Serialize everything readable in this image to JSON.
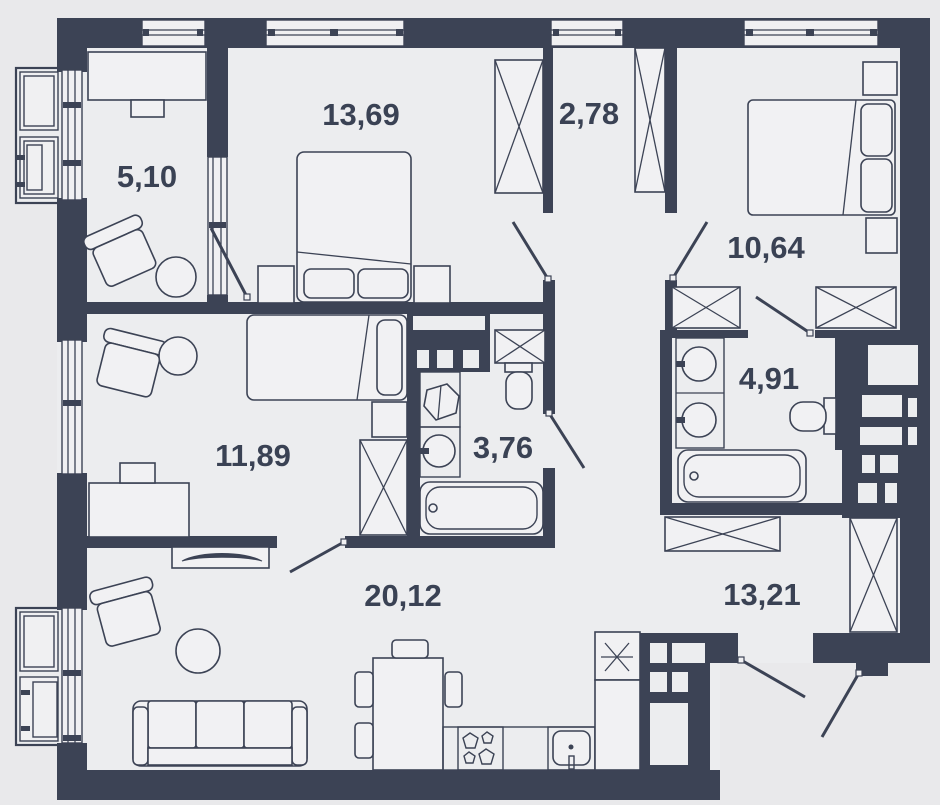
{
  "figure": {
    "type": "apartment-floor-plan",
    "description": "Top-view architectural floor plan with room areas in square meters"
  },
  "rooms": [
    {
      "id": "room-5-10",
      "area": "5,10",
      "furniture": [
        "desk",
        "office-chair",
        "stool",
        "window",
        "balcony"
      ]
    },
    {
      "id": "room-13-69",
      "area": "13,69",
      "furniture": [
        "double-bed",
        "nightstand",
        "nightstand",
        "wardrobe",
        "window"
      ]
    },
    {
      "id": "room-2-78",
      "area": "2,78",
      "furniture": [
        "wardrobe",
        "window"
      ]
    },
    {
      "id": "room-10-64",
      "area": "10,64",
      "furniture": [
        "double-bed",
        "nightstand",
        "nightstand",
        "wardrobe",
        "wardrobe",
        "window"
      ]
    },
    {
      "id": "room-4-91",
      "area": "4,91",
      "furniture": [
        "sink",
        "sink",
        "toilet",
        "bathtub",
        "ventilation-shaft"
      ]
    },
    {
      "id": "room-3-76",
      "area": "3,76",
      "furniture": [
        "washing-machine",
        "sink",
        "toilet",
        "bathtub",
        "ventilation-shaft"
      ]
    },
    {
      "id": "room-11-89",
      "area": "11,89",
      "furniture": [
        "single-bed",
        "nightstand",
        "wardrobe",
        "armchair",
        "round-table",
        "desk",
        "tv-stand",
        "window"
      ]
    },
    {
      "id": "room-20-12",
      "area": "20,12",
      "furniture": [
        "sofa",
        "armchair",
        "coffee-table",
        "dining-table",
        "chairs",
        "stove",
        "kitchen-sink",
        "fridge",
        "balcony-door"
      ]
    },
    {
      "id": "room-13-21",
      "area": "13,21",
      "furniture": [
        "wardrobe",
        "wardrobe",
        "entrance-door"
      ]
    }
  ],
  "colors": {
    "wall": "#3C4355",
    "floor": "#ECEDEF",
    "outside": "#E9E9EB",
    "furniture_fill": "#F1F1F3",
    "label_text": "#3A4254"
  }
}
